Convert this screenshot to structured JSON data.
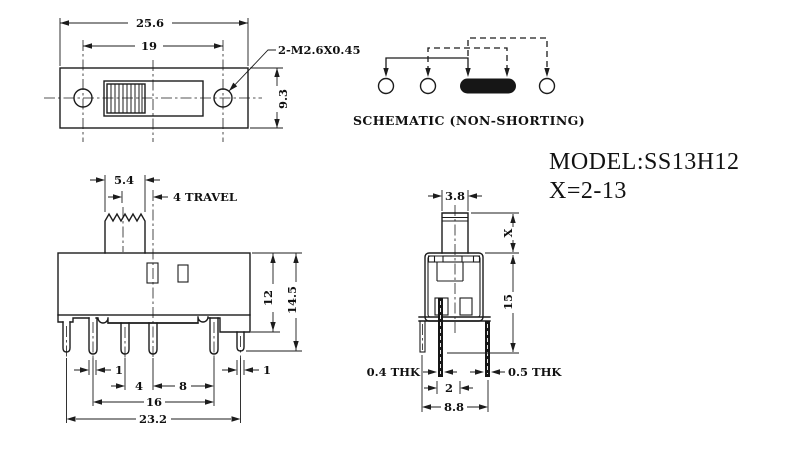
{
  "title": {
    "model": "MODEL:SS13H12",
    "x_range": "X=2-13"
  },
  "schematic": {
    "caption": "SCHEMATIC (NON-SHORTING)"
  },
  "top_view": {
    "overall_width": "25.6",
    "hole_spacing": "19",
    "body_depth": "9.3",
    "thread_note": "2-M2.6X0.45"
  },
  "front_view": {
    "knob_width": "5.4",
    "travel_note": "4 TRAVEL",
    "pin_width_left": "1",
    "pin_pitch": "4",
    "pin_pitch_right": "8",
    "leg_width_right": "1",
    "pin_span": "16",
    "base_width": "23.2",
    "body_height": "12",
    "overall_height": "14.5"
  },
  "side_view": {
    "stem_width": "3.8",
    "stem_height": "X",
    "body_height": "15",
    "thickness_left": "0.4 THK",
    "thickness_right": "0.5 THK",
    "pin_offset": "2",
    "pin_span": "8.8"
  }
}
